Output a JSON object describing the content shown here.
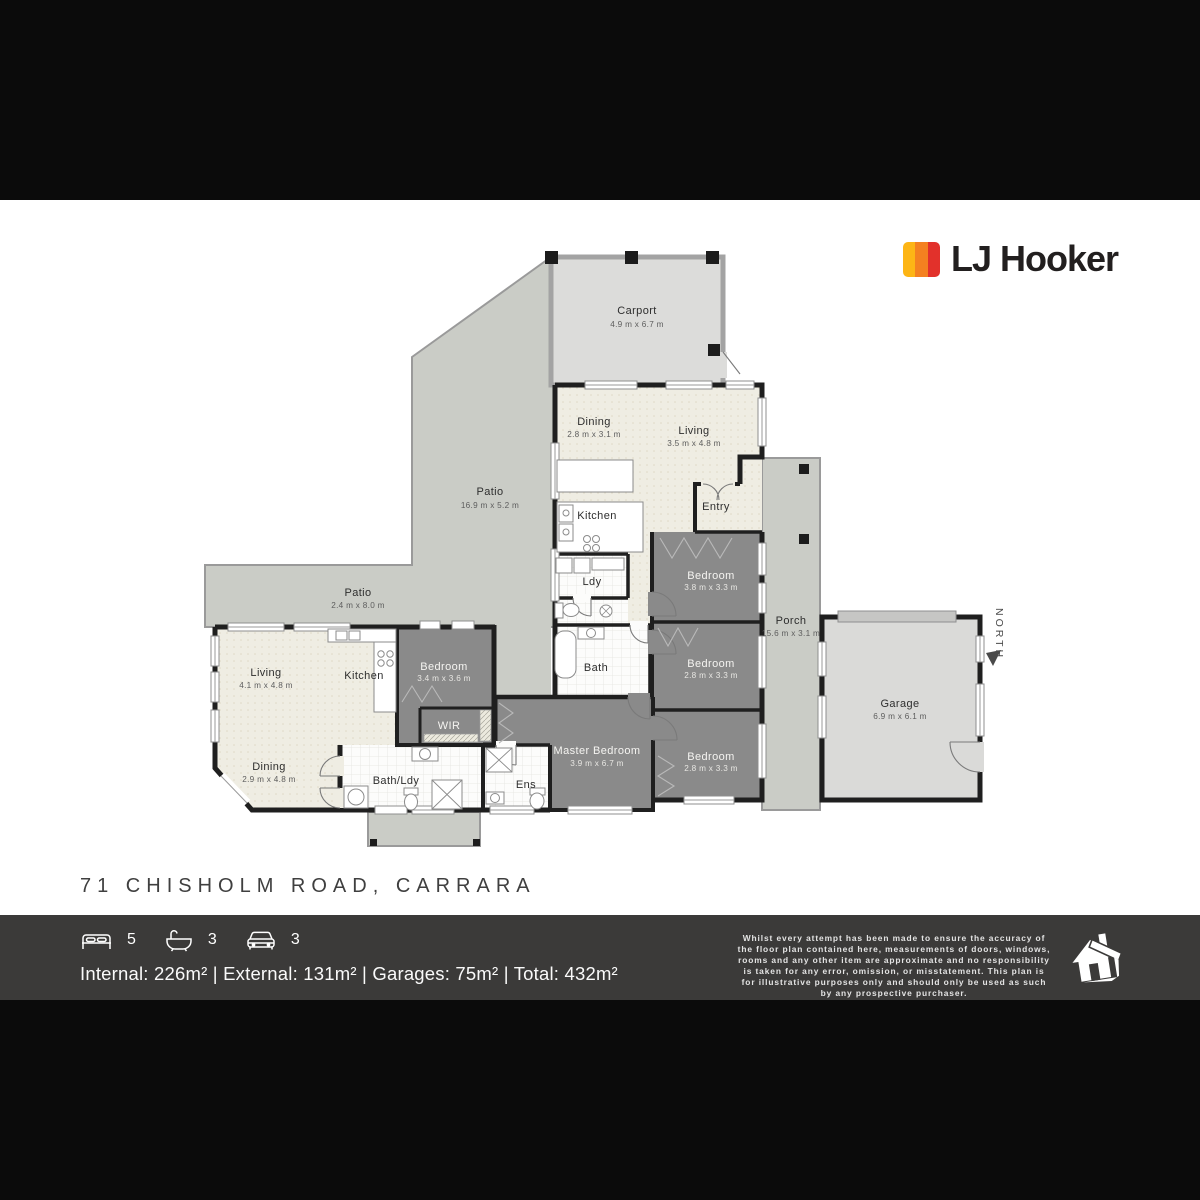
{
  "logo": {
    "brand": "LJ Hooker",
    "bar_colors": [
      "#FDB515",
      "#F48120",
      "#E2312B"
    ]
  },
  "address": "71 CHISHOLM ROAD, CARRARA",
  "floorplan": {
    "north_label": "NORTH",
    "palette": {
      "patio_gray": "#caccc6",
      "carport_gray": "#dcdcda",
      "garage_gray": "#dadad8",
      "bedroom_gray": "#8a8a8a",
      "interior_cream": "#efede3",
      "wall_black": "#1f1f1f"
    },
    "rooms": {
      "carport": {
        "name": "Carport",
        "dims": "4.9 m x 6.7 m"
      },
      "patio_top": {
        "name": "Patio",
        "dims": "16.9 m x 5.2 m"
      },
      "dining_top": {
        "name": "Dining",
        "dims": "2.8 m x 3.1 m"
      },
      "living_top": {
        "name": "Living",
        "dims": "3.5 m x 4.8 m"
      },
      "kitchen_top": {
        "name": "Kitchen"
      },
      "entry": {
        "name": "Entry"
      },
      "ldy": {
        "name": "Ldy"
      },
      "bedroom_ne": {
        "name": "Bedroom",
        "dims": "3.8 m x 3.3 m"
      },
      "bedroom_e": {
        "name": "Bedroom",
        "dims": "2.8 m x 3.3 m"
      },
      "bedroom_se": {
        "name": "Bedroom",
        "dims": "2.8 m x 3.3 m"
      },
      "porch": {
        "name": "Porch",
        "dims": "15.6 m x 3.1 m"
      },
      "garage": {
        "name": "Garage",
        "dims": "6.9 m x 6.1 m"
      },
      "patio_left": {
        "name": "Patio",
        "dims": "2.4 m x 8.0 m"
      },
      "living_left": {
        "name": "Living",
        "dims": "4.1 m x 4.8 m"
      },
      "kitchen_left": {
        "name": "Kitchen"
      },
      "dining_left": {
        "name": "Dining",
        "dims": "2.9 m x 4.8 m"
      },
      "bedroom_mid": {
        "name": "Bedroom",
        "dims": "3.4 m x 3.6 m"
      },
      "wir": {
        "name": "WIR"
      },
      "bath": {
        "name": "Bath"
      },
      "bath_ldy": {
        "name": "Bath/Ldy"
      },
      "ens": {
        "name": "Ens"
      },
      "master": {
        "name": "Master Bedroom",
        "dims": "3.9 m x 6.7 m"
      }
    }
  },
  "footer": {
    "beds": "5",
    "baths": "3",
    "cars": "3",
    "areas": "Internal: 226m² | External: 131m² | Garages: 75m² | Total: 432m²",
    "disclaimer": "Whilst every attempt has been made to ensure the accuracy of the floor plan contained here, measurements of doors, windows, rooms and any other item are approximate and no responsibility is taken for any error, omission, or misstatement. This plan is for illustrative purposes only and should only be used as such by any prospective purchaser."
  }
}
